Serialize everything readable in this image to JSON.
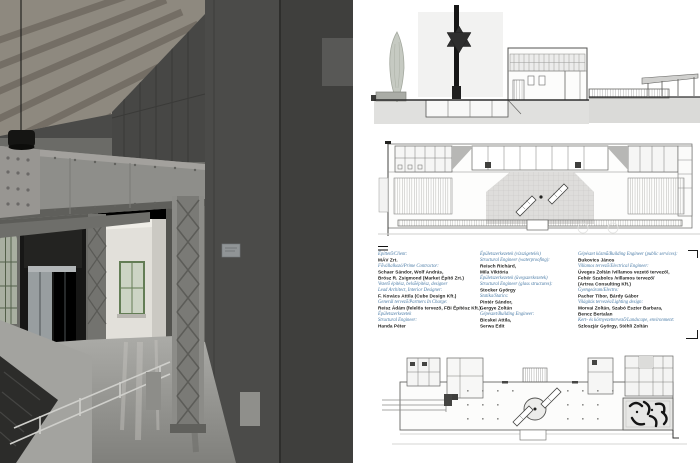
{
  "colors": {
    "accent_blue": "#4a7ba6",
    "ink": "#1c1c1a",
    "page_bg": "#ffffff"
  },
  "credits": {
    "columns": [
      {
        "lines": [
          {
            "style": "label",
            "text": "Építtető/Client:"
          },
          {
            "style": "name",
            "text": "MÁV Zrt."
          },
          {
            "style": "label",
            "text": "Fővállalkozó/Prime Contractor:"
          },
          {
            "style": "name",
            "text": "Schaer Sándor, Wolf András,"
          },
          {
            "style": "name",
            "text": "Brósz R. Zsigmond (Market Építő Zrt.)"
          },
          {
            "style": "label",
            "text": "Vezető építész, belsőépítész, designer"
          },
          {
            "style": "label",
            "text": "Lead Architect, Interior Designer:"
          },
          {
            "style": "name",
            "text": "F. Kovács Attila (Cube Design Kft.)"
          },
          {
            "style": "label",
            "text": "Generál tervező/Partners In Charge:"
          },
          {
            "style": "name",
            "text": "Reisz Ádám (felelős tervező, FBI Építész Kft.)"
          },
          {
            "style": "label",
            "text": "Épületszerkezetek"
          },
          {
            "style": "label",
            "text": "Structural Engineer:"
          },
          {
            "style": "name",
            "text": "Handa Péter"
          }
        ]
      },
      {
        "lines": [
          {
            "style": "label",
            "text": "Épületszerkezetek (vízszigetelés)"
          },
          {
            "style": "label",
            "text": "Structural Engineer (waterproofing):"
          },
          {
            "style": "name",
            "text": "Reisch Richárd,"
          },
          {
            "style": "name",
            "text": "Mila Viktória"
          },
          {
            "style": "label",
            "text": "Épületszerkezetek (üvegszerkezetek)"
          },
          {
            "style": "label",
            "text": "Structural Engineer (glass structures):"
          },
          {
            "style": "name",
            "text": "Stocker György"
          },
          {
            "style": "label",
            "text": "Statika/Statics:"
          },
          {
            "style": "name",
            "text": "Pintér Sándor,"
          },
          {
            "style": "name",
            "text": "Gergye Zoltán"
          },
          {
            "style": "label",
            "text": "Gépészet/Building Engineer:"
          },
          {
            "style": "name",
            "text": "Bicskei Attila,"
          },
          {
            "style": "name",
            "text": "Serwa Edit"
          }
        ]
      },
      {
        "lines": [
          {
            "style": "label",
            "text": "Gépészet közmű/Building Engineer (public services):"
          },
          {
            "style": "name",
            "text": "Bukovics János"
          },
          {
            "style": "label",
            "text": "Villamos tervező/Electrical Engineer:"
          },
          {
            "style": "name",
            "text": "Üveges Zoltán /villamos vezető tervező/,"
          },
          {
            "style": "name",
            "text": "Fehér Szabolcs /villamos tervező/"
          },
          {
            "style": "name",
            "text": "(Artrea Consulting Kft.)"
          },
          {
            "style": "label",
            "text": "Gyengeáram/Electro:"
          },
          {
            "style": "name",
            "text": "Pacher Tibor, Bárdy Gábor"
          },
          {
            "style": "label",
            "text": "Világítás tervezés/Lighting design:"
          },
          {
            "style": "name",
            "text": "Morvai Zoltán, Szabó Eszter Barbara,"
          },
          {
            "style": "name",
            "text": "Bencz Bertalan"
          },
          {
            "style": "label",
            "text": "Kert- és környezettervező/Landscape, environment:"
          },
          {
            "style": "name",
            "text": "Szloszjár György, Stéhli Zoltán"
          }
        ]
      }
    ]
  }
}
